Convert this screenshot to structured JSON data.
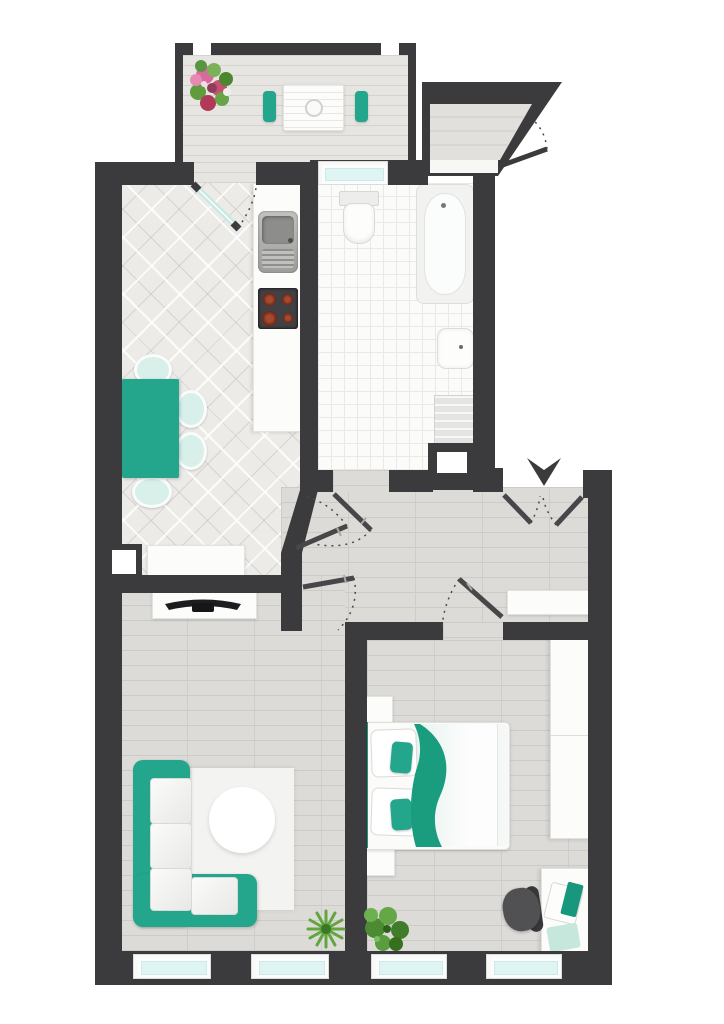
{
  "app": {
    "title": "apartment-floor-plan",
    "visible_text": []
  },
  "palette": {
    "wall": "#3b3b3d",
    "teal": "#23a68b",
    "teal-dark": "#17977c",
    "teal-light": "#d9efe9",
    "glass": "#def5f4",
    "wood": "#dcdbd8",
    "wood-line": "#cccbc8",
    "tile-bath": "#fbfbfa",
    "tile-line": "#e9e9e7",
    "rug": "#f3f3f1",
    "white-furn": "#fcfcfb",
    "furn-border": "#e2e2e0",
    "chair-dark": "#4b4b4d",
    "plant-green": "#5c9c3f",
    "plant-dark": "#3f7a2b",
    "flower-pink": "#d76b9e",
    "flower-red": "#b03a57",
    "steel": "#a8a8a6",
    "burner": "#7c2d1d"
  },
  "rooms": [
    {
      "id": "balcony",
      "furniture": [
        "flower-pot",
        "bistro-table",
        "balcony-chair-left",
        "balcony-chair-right"
      ]
    },
    {
      "id": "kitchen",
      "furniture": [
        "counter",
        "kitchen-sink",
        "cooktop",
        "dining-table",
        "dining-chairs",
        "sideboard",
        "balcony-door"
      ]
    },
    {
      "id": "bathroom",
      "furniture": [
        "toilet",
        "bathtub",
        "wash-basin",
        "washing-machine",
        "shaft",
        "window"
      ]
    },
    {
      "id": "hallway",
      "furniture": [
        "sideboard",
        "entrance-double-door",
        "entrance-arrow"
      ]
    },
    {
      "id": "stair-landing",
      "furniture": [
        "stairwell-door"
      ]
    },
    {
      "id": "living-room",
      "furniture": [
        "tv-lowboard",
        "tv",
        "corner-sofa",
        "rug",
        "coffee-table",
        "plant",
        "windows"
      ]
    },
    {
      "id": "bedroom",
      "furniture": [
        "double-bed",
        "pillows",
        "nightstands",
        "wardrobe",
        "desk",
        "laptop",
        "office-chair",
        "plant",
        "windows"
      ]
    }
  ],
  "doors": [
    "balcony-door",
    "kitchen-door",
    "bathroom-door",
    "living-room-door",
    "bedroom-door",
    "entrance-double-door",
    "stairwell-door"
  ]
}
